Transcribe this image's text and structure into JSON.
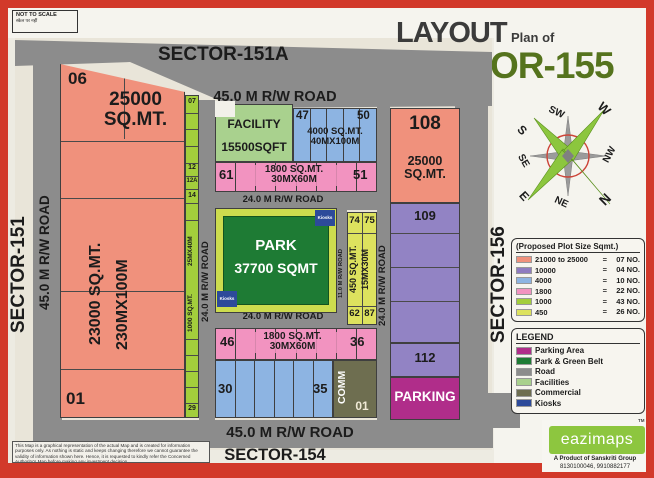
{
  "meta": {
    "not_to_scale": "NOT TO SCALE",
    "not_to_scale_sub": "स्केल पर नहीं",
    "disclaimer": "This Map is a graphical representation of the actual Map and is created for information purposes only. As nothing is static and keeps changing therefore we cannot guarantee the validity of information shown here. Hence, it is requested to kindly refer the Concerned Authority's Map before making any investment decision."
  },
  "title": {
    "layout": "LAYOUT",
    "plan_of": "Plan of",
    "sector": "SECTOR-155"
  },
  "sectors": {
    "top": "SECTOR-151A",
    "left": "SECTOR-151",
    "right": "SECTOR-156",
    "bottom": "SECTOR-154"
  },
  "roads": {
    "r45": "45.0 M R/W ROAD",
    "r24": "24.0 M R/W ROAD",
    "r11": "11.0 M R/W ROAD"
  },
  "plots": {
    "p06": "06",
    "p06_area": "25000\nSQ.MT.",
    "p01_left": "01",
    "big_area": "23000 SQ.MT.",
    "big_dim": "230MX100M",
    "s07": "07",
    "s12": "12",
    "s12a": "12A",
    "s14": "14",
    "s29": "29",
    "strip_dim": "25MX40M",
    "strip_area": "1000 SQ.MT.",
    "facility_name": "FACILITY",
    "facility_area": "15500SQFT",
    "b47": "47",
    "b50": "50",
    "blue_area": "4000 SQ.MT.\n40MX100M",
    "pt61": "61",
    "pt51": "51",
    "pink_area": "1800 SQ.MT.\n30MX60M",
    "p108": "108",
    "p108_area": "25000\nSQ.MT.",
    "p109": "109",
    "p112": "112",
    "y74": "74",
    "y75": "75",
    "y62": "62",
    "y87": "87",
    "y_area": "450 SQ.MT.",
    "y_dim": "15MX30M",
    "pb46": "46",
    "pb36": "36",
    "b30": "30",
    "b35": "35",
    "comm": "COMM",
    "comm_no": "01",
    "parking": "PARKING"
  },
  "park": {
    "name": "PARK",
    "area": "37700 SQMT",
    "kiosk": "Kiosks"
  },
  "plot_size_legend": {
    "title": "(Proposed Plot Size Sqmt.)",
    "eq": "=",
    "rows": [
      {
        "color": "#f0917c",
        "label": "21000 to 25000",
        "count": "07 NO."
      },
      {
        "color": "#8f7cc0",
        "label": "10000",
        "count": "04 NO."
      },
      {
        "color": "#8db4e2",
        "label": "4000",
        "count": "10 NO."
      },
      {
        "color": "#f293c0",
        "label": "1800",
        "count": "22 NO."
      },
      {
        "color": "#a3ce3c",
        "label": "1000",
        "count": "43 NO."
      },
      {
        "color": "#dde25e",
        "label": "450",
        "count": "26 NO."
      }
    ]
  },
  "legend": {
    "title": "LEGEND",
    "rows": [
      {
        "color": "#b02d8a",
        "label": "Parking Area"
      },
      {
        "color": "#1e7b34",
        "label": "Park & Green Belt"
      },
      {
        "color": "#8c8c8c",
        "label": "Road"
      },
      {
        "color": "#a9d18e",
        "label": "Facilities"
      },
      {
        "color": "#6e6e50",
        "label": "Commercial"
      },
      {
        "color": "#2d4a9a",
        "label": "Kiosks"
      }
    ]
  },
  "compass": {
    "n": "N",
    "ne": "NE",
    "e": "E",
    "se": "SE",
    "s": "S",
    "sw": "SW",
    "w": "W",
    "nw": "NW"
  },
  "branding": {
    "logo": "eazimaps",
    "tm": "TM",
    "byline": "A Product of Sanskriti Group",
    "phone": "8130100046, 9910882177"
  }
}
